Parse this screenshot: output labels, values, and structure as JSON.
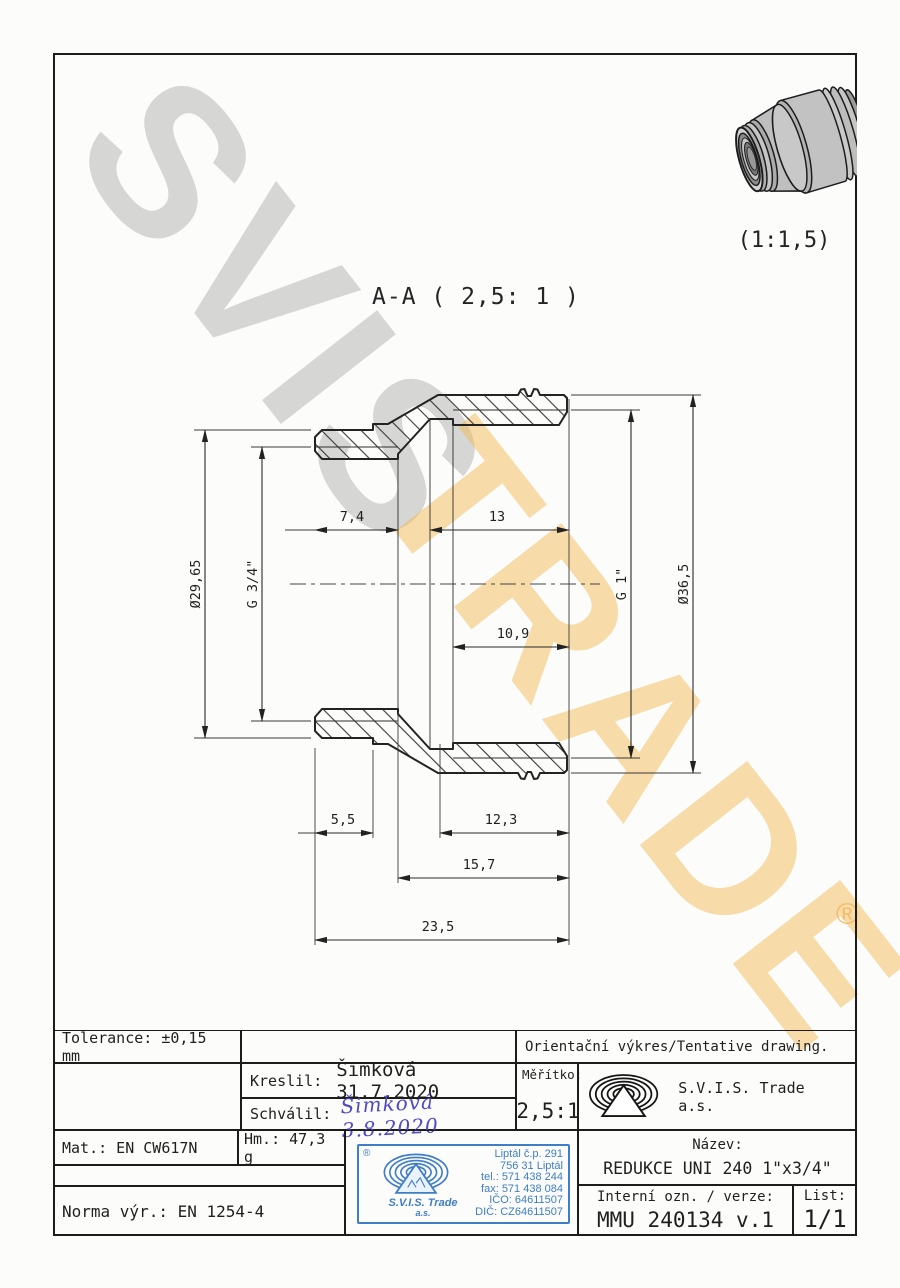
{
  "watermark": {
    "line1": "SVIS",
    "line2": "TRADE",
    "registered": "®"
  },
  "drawing": {
    "section_label": "A-A ( 2,5: 1 )",
    "perspective_scale": "(1:1,5)",
    "dims": {
      "bore_left": "7,4",
      "thread_len_right": "13",
      "runout_right": "10,9",
      "dia_left": "Ø29,65",
      "thread_left": "G 3/4\"",
      "thread_right": "G 1\"",
      "dia_right": "Ø36,5",
      "land_left": "5,5",
      "len_right_bottom": "12,3",
      "len_mid": "15,7",
      "total_len": "23,5"
    }
  },
  "title_block": {
    "tolerance": "Tolerance: ±0,15 mm",
    "orientation_note": "Orientační výkres/Tentative drawing.",
    "kreslil_label": "Kreslil:",
    "kreslil_value": "Šimková 31.7.2020",
    "schvalil_label": "Schválil:",
    "schvalil_value": "Šimková 3.8.2020",
    "meritko_label": "Měřítko:",
    "meritko_value": "2,5:1",
    "company": "S.V.I.S. Trade a.s.",
    "mat": "Mat.: EN CW617N",
    "hm": "Hm.: 47,3 g",
    "norma": "Norma výr.: EN 1254-4",
    "nazev_label": "Název:",
    "nazev_value": "REDUKCE UNI 240 1\"x3/4\"",
    "interni_label": "Interní ozn. / verze:",
    "interni_value": "MMU 240134 v.1",
    "list_label": "List:",
    "list_value": "1/1",
    "stamp": {
      "registered": "®",
      "company": "S.V.I.S. Trade",
      "suffix": "a.s.",
      "line1": "Liptál č.p. 291",
      "line2": "756 31 Liptál",
      "line3": "tel.: 571 438 244",
      "line4": "fax: 571 438 084",
      "line5": "IČO: 64611507",
      "line6": "DIČ: CZ64611507"
    }
  }
}
